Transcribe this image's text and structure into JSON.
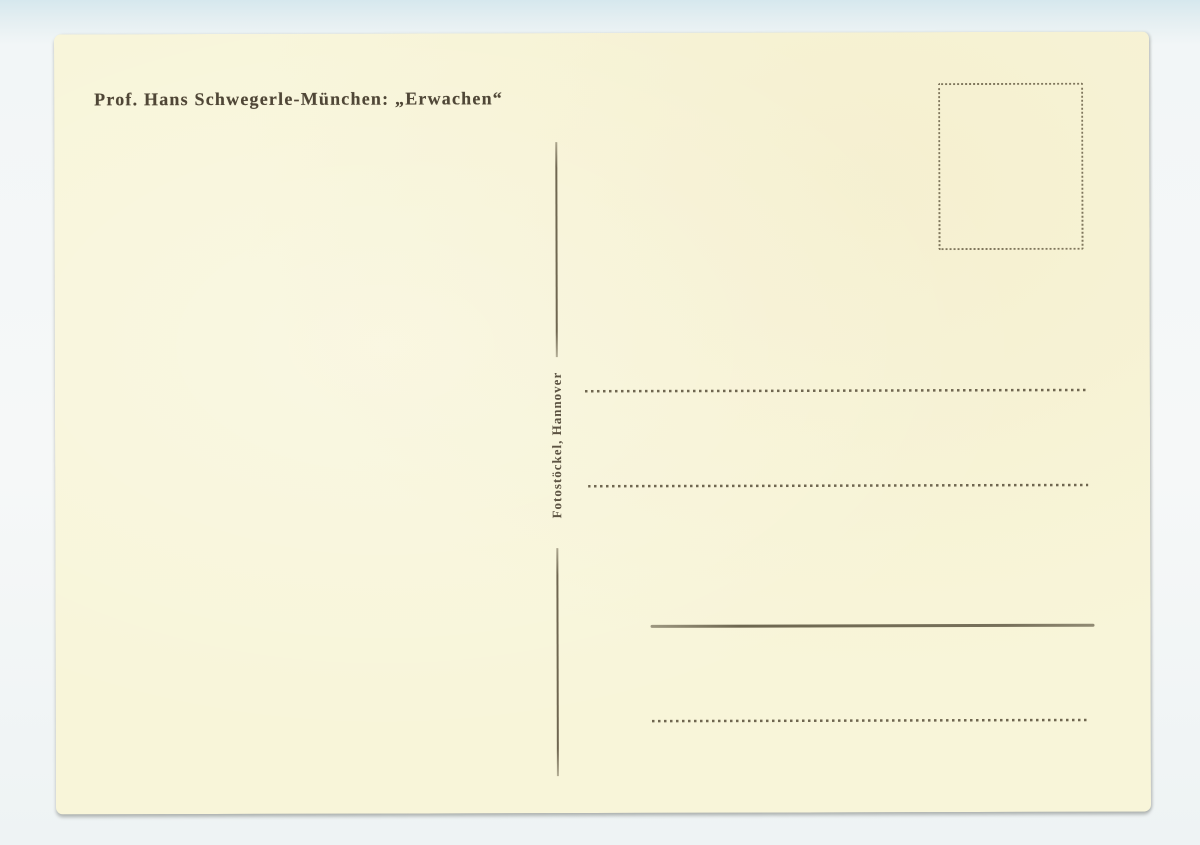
{
  "postcard": {
    "caption": "Prof. Hans Schwegerle-München: „Erwachen“",
    "publisher": "Fotostöckel, Hannover",
    "colors": {
      "card": "#f8f5d9",
      "ink": "#4f4636",
      "line": "#6f6650",
      "background": "#f3f7f8"
    }
  }
}
